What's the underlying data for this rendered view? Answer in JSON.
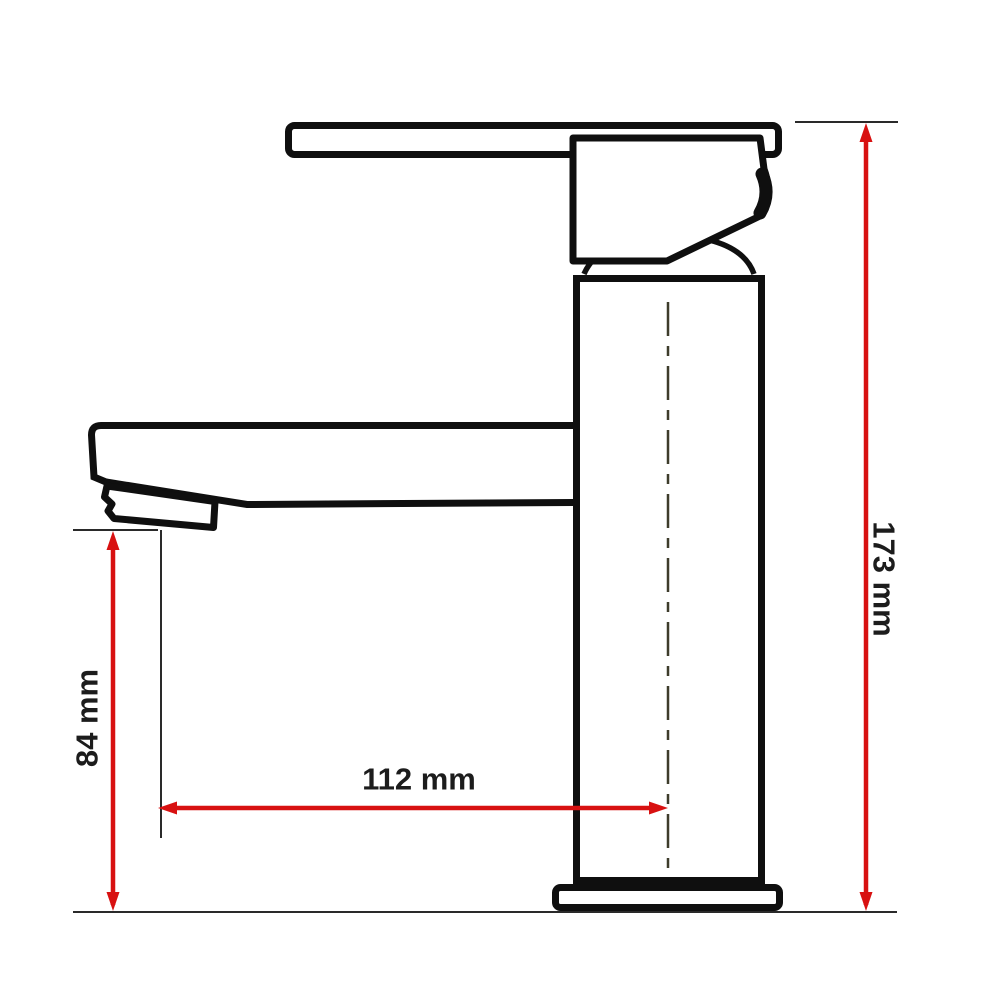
{
  "diagram": {
    "type": "technical-dimension-drawing",
    "subject": "basin-mixer-faucet-side-view",
    "dimensions": {
      "total_height": {
        "label": "173 mm",
        "value": 173,
        "unit": "mm",
        "orientation": "vertical",
        "side": "right"
      },
      "spout_height": {
        "label": "84 mm",
        "value": 84,
        "unit": "mm",
        "orientation": "vertical",
        "side": "left"
      },
      "spout_reach": {
        "label": "112 mm",
        "value": 112,
        "unit": "mm",
        "orientation": "horizontal",
        "side": "middle"
      }
    },
    "colors": {
      "dimension_red": "#d81111",
      "ink": "#0f0f0f",
      "extension_line": "#2a2a2a",
      "centerline": "#3e3c2b",
      "background": "#ffffff"
    }
  }
}
